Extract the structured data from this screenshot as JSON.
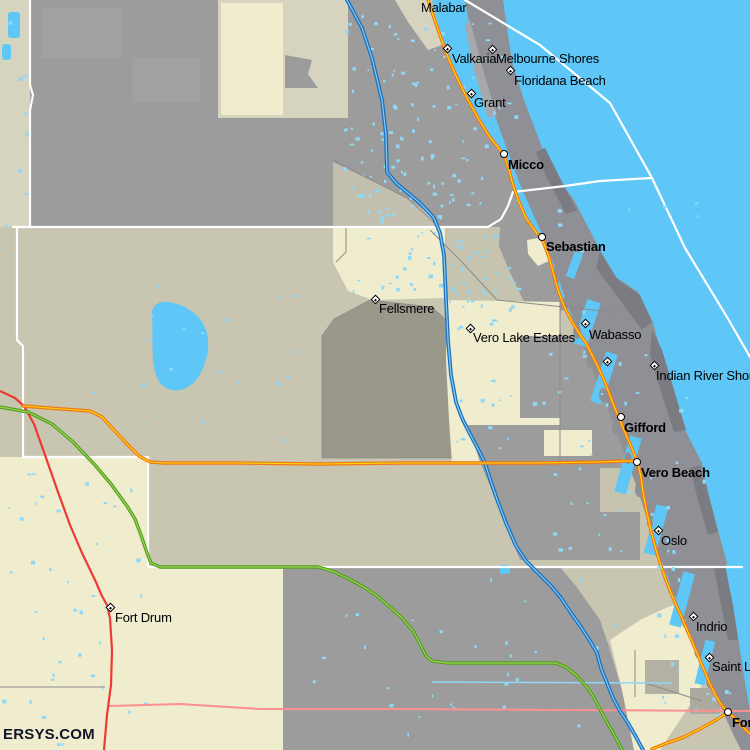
{
  "watermark": "ERSYS.COM",
  "colors": {
    "ocean": "#5EC7F8",
    "land_khaki": "#C8C5B0",
    "land_khaki_light": "#D6D3BE",
    "land_cream": "#EFEDCE",
    "urban_gray": "#9C9C9C",
    "fellsmere_gray": "#9A978B",
    "island_gray": "#8E9095",
    "island_dark_gray": "#7A7C81",
    "county_line": "#FFFFFF",
    "minor_line": "#8C8C8C",
    "road_orange": "#F0751D",
    "road_orange_center": "#FFDD00",
    "road_blue": "#1A6FBE",
    "road_blue_center": "#7FC8F2",
    "road_green": "#4E9C20",
    "road_green_center": "#9CD34F",
    "road_red": "#EE3A30",
    "boundary_pink": "#FB9090",
    "canal_blue": "#8FD8F8",
    "label_color": "#000000"
  },
  "places": [
    {
      "label": "Malabar",
      "marker": "none",
      "mx": 0,
      "my": 0,
      "lx": 421,
      "ly": 1,
      "bold": false
    },
    {
      "label": "Valkaria",
      "marker": "diamond",
      "mx": 447,
      "my": 48,
      "lx": 452,
      "ly": 52,
      "bold": false
    },
    {
      "label": "Melbourne Shores",
      "marker": "diamond",
      "mx": 492,
      "my": 49,
      "lx": 496,
      "ly": 52,
      "bold": false
    },
    {
      "label": "Floridana Beach",
      "marker": "diamond",
      "mx": 510,
      "my": 70,
      "lx": 514,
      "ly": 74,
      "bold": false
    },
    {
      "label": "Grant",
      "marker": "diamond",
      "mx": 471,
      "my": 93,
      "lx": 474,
      "ly": 96,
      "bold": false
    },
    {
      "label": "Micco",
      "marker": "circle",
      "mx": 504,
      "my": 154,
      "lx": 508,
      "ly": 158,
      "bold": true
    },
    {
      "label": "Sebastian",
      "marker": "circle",
      "mx": 542,
      "my": 237,
      "lx": 546,
      "ly": 240,
      "bold": true
    },
    {
      "label": "Fellsmere",
      "marker": "diamond",
      "mx": 375,
      "my": 299,
      "lx": 379,
      "ly": 302,
      "bold": false
    },
    {
      "label": "Vero Lake Estates",
      "marker": "diamond",
      "mx": 470,
      "my": 328,
      "lx": 473,
      "ly": 331,
      "bold": false
    },
    {
      "label": "Wabasso",
      "marker": "diamond",
      "mx": 585,
      "my": 323,
      "lx": 589,
      "ly": 328,
      "bold": false
    },
    {
      "label": "",
      "marker": "diamond",
      "mx": 607,
      "my": 361,
      "lx": 611,
      "ly": 365,
      "bold": false
    },
    {
      "label": "Indian River Shores",
      "marker": "diamond",
      "mx": 654,
      "my": 365,
      "lx": 656,
      "ly": 369,
      "bold": false
    },
    {
      "label": "Gifford",
      "marker": "circle",
      "mx": 621,
      "my": 417,
      "lx": 624,
      "ly": 421,
      "bold": true
    },
    {
      "label": "Vero Beach",
      "marker": "circle",
      "mx": 637,
      "my": 462,
      "lx": 641,
      "ly": 466,
      "bold": true
    },
    {
      "label": "Oslo",
      "marker": "diamond",
      "mx": 658,
      "my": 530,
      "lx": 661,
      "ly": 534,
      "bold": false
    },
    {
      "label": "Fort Drum",
      "marker": "diamond",
      "mx": 110,
      "my": 607,
      "lx": 115,
      "ly": 611,
      "bold": false
    },
    {
      "label": "Indrio",
      "marker": "diamond",
      "mx": 693,
      "my": 616,
      "lx": 696,
      "ly": 620,
      "bold": false
    },
    {
      "label": "Saint Lucie",
      "marker": "diamond",
      "mx": 709,
      "my": 657,
      "lx": 712,
      "ly": 660,
      "bold": false
    },
    {
      "label": "Fort Pierce",
      "marker": "circle",
      "mx": 728,
      "my": 712,
      "lx": 732,
      "ly": 716,
      "bold": true
    }
  ]
}
